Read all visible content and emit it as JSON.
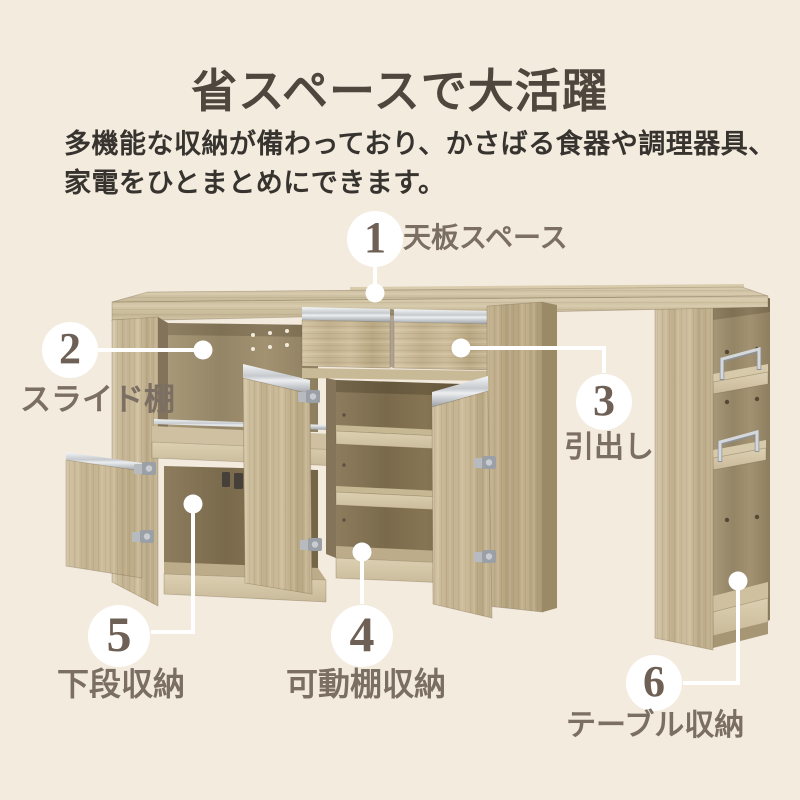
{
  "header": {
    "title": "省スペースで大活躍",
    "description_line1": "多機能な収納が備わっており、かさばる食器や調理器具、",
    "description_line2": "家電をひとまとめにできます。"
  },
  "callouts": [
    {
      "number": "1",
      "label": "天板スペース"
    },
    {
      "number": "2",
      "label": "スライド棚"
    },
    {
      "number": "3",
      "label": "引出し"
    },
    {
      "number": "4",
      "label": "可動棚収納"
    },
    {
      "number": "5",
      "label": "下段収納"
    },
    {
      "number": "6",
      "label": "テーブル収納"
    }
  ],
  "illustration": {
    "alt": "キッチンカウンターの機能イラスト（天板スペース・スライド棚・引出し・可動棚収納・下段収納・テーブル収納）"
  },
  "colors": {
    "background": "#f4ebdf",
    "title_text": "#4f463d",
    "body_text": "#37342f",
    "callout_number": "#6e6055",
    "callout_label": "#7b6e62",
    "callout_accent": "#ffffff",
    "wood_light": "#d3c6a7",
    "wood_medium": "#c2b190",
    "wood_dark": "#8e7e5f",
    "metal": "#c2c6ca"
  }
}
